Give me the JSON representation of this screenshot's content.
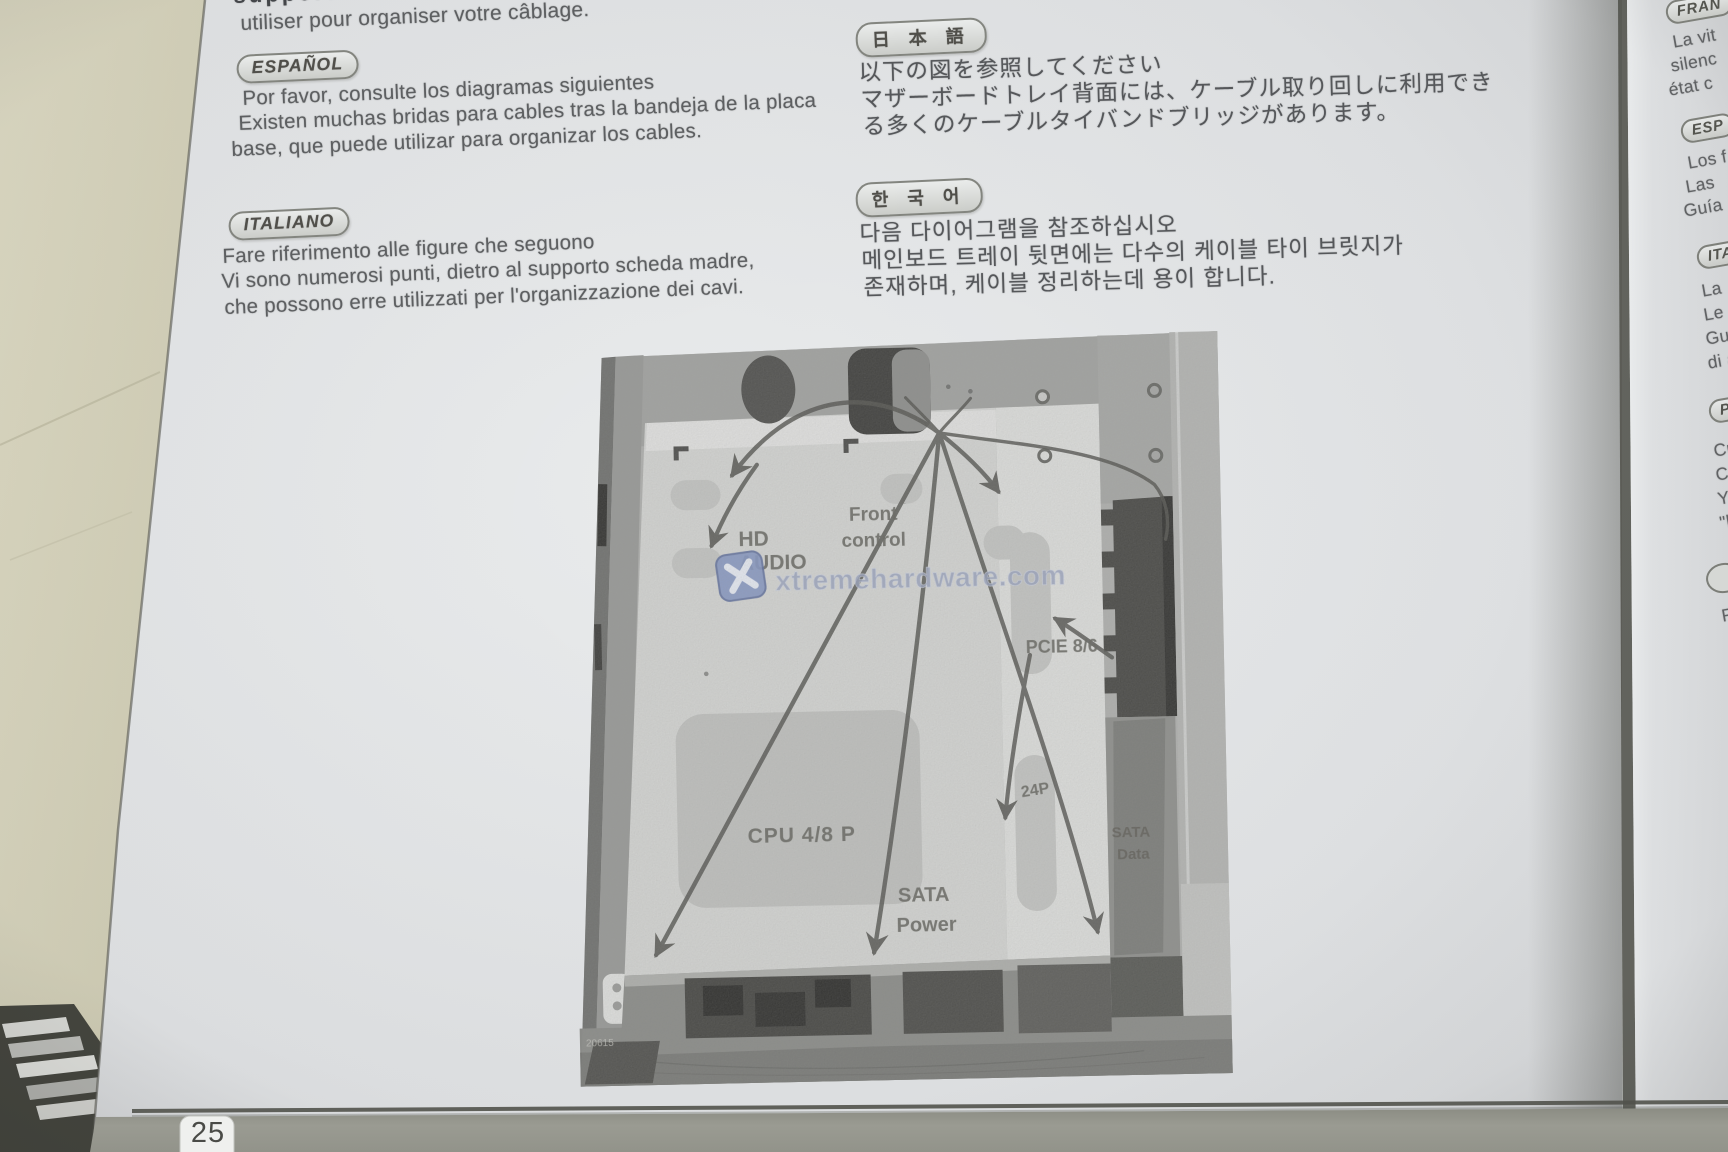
{
  "colors": {
    "paper": "#e4e6e8",
    "table_surface": "#d7d4bd",
    "footer_band": "#97988f",
    "watermark_blue": "#8496c4",
    "photo_gray": "#b0b1af"
  },
  "page": {
    "french": {
      "clipped": "support de la",
      "line1": "utiliser pour organiser votre câblage."
    },
    "espanol": {
      "badge": "ESPAÑOL",
      "line1": "Por favor, consulte los diagramas siguientes",
      "line2": "Existen muchas bridas para cables tras la bandeja de la placa",
      "line3": "base, que puede utilizar para organizar los cables."
    },
    "italiano": {
      "badge": "ITALIANO",
      "line1": "Fare riferimento alle figure che seguono",
      "line2": "Vi sono numerosi punti, dietro al supporto scheda madre,",
      "line3": "che possono erre utilizzati per l'organizzazione dei cavi."
    },
    "japanese": {
      "badge": "日 本 語",
      "line1": "以下の図を参照してください",
      "line2": "マザーボードトレイ背面には、ケーブル取り回しに利用でき",
      "line3": "る多くのケーブルタイバンドブリッジがあります。"
    },
    "korean": {
      "badge": "한 국 어",
      "line1": "다음 다이어그램을 참조하십시오",
      "line2": "메인보드 트레이 뒷면에는 다수의 케이블 타이 브릿지가",
      "line3": "존재하며, 케이블 정리하는데 용이 합니다."
    },
    "page_number": "25"
  },
  "diagram": {
    "labels": {
      "hd": "HD",
      "audio": "AUDIO",
      "front": "Front",
      "control": "control",
      "pcie": "PCIE 8/6",
      "atx": "24P",
      "cpu": "CPU 4/8 P",
      "sata_power_1": "SATA",
      "sata_power_2": "Power",
      "sata_data_1": "SATA",
      "sata_data_2": "Data",
      "code": "20615"
    },
    "watermark": "xtremehardware.com"
  },
  "next_page": {
    "francais_badge": "FRAN",
    "francais_lines": [
      "La vit",
      "silenc",
      "état c"
    ],
    "espanol_badge": "ESP",
    "espanol_lines": [
      "Los f",
      "Las",
      "Guía"
    ],
    "italiano_badge": "ITA",
    "italiano_lines": [
      "La",
      "Le",
      "Gu",
      "di a"
    ],
    "p_badge": "P",
    "p_lines": [
      "Cu",
      "C",
      "Y",
      "\"k"
    ],
    "f_fragment": "F"
  }
}
